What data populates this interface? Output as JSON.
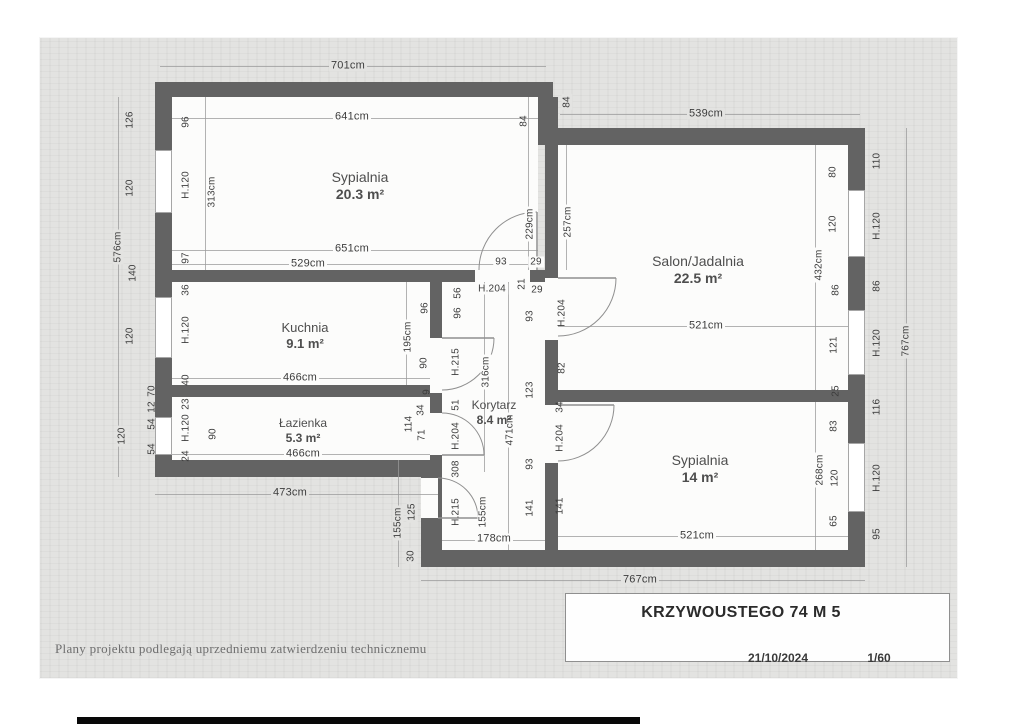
{
  "title_block": {
    "title": "KRZYWOUSTEGO 74 M 5",
    "date": "21/10/2024",
    "scale": "1/60"
  },
  "footer": {
    "note": "Plany projektu podlegają uprzedniemu zatwierdzeniu technicznemu"
  },
  "colors": {
    "paper": "#e3e3e1",
    "wall": "#636363",
    "room_fill": "#fcfcfb",
    "dim_text": "#3c3c3c",
    "dim_line": "#9a9a9a",
    "door_line": "#8f8f8f"
  },
  "plan": {
    "rooms": [
      {
        "name": "Sypialnia",
        "area": "20.3 m²",
        "rect": [
          172,
          97,
          366,
          173
        ],
        "label": [
          360,
          186
        ],
        "size": 14
      },
      {
        "name": "Salon/Jadalnia",
        "area": "22.5 m²",
        "rect": [
          558,
          145,
          290,
          245
        ],
        "label": [
          698,
          270
        ],
        "size": 14
      },
      {
        "name": "Kuchnia",
        "area": "9.1 m²",
        "rect": [
          172,
          282,
          258,
          103
        ],
        "label": [
          305,
          336
        ],
        "size": 13
      },
      {
        "name": "Łazienka",
        "area": "5.3 m²",
        "rect": [
          172,
          397,
          258,
          63
        ],
        "label": [
          303,
          431
        ],
        "size": 12
      },
      {
        "name": "Korytarz",
        "area": "8.4 m²",
        "rect": [
          442,
          282,
          103,
          268
        ],
        "label": [
          494,
          413
        ],
        "size": 12
      },
      {
        "name": "Sypialnia",
        "area": "14 m²",
        "rect": [
          558,
          402,
          290,
          148
        ],
        "label": [
          700,
          469
        ],
        "size": 14
      }
    ],
    "walls": [
      [
        155,
        82,
        398,
        15
      ],
      [
        538,
        97,
        20,
        48
      ],
      [
        545,
        128,
        320,
        17
      ],
      [
        155,
        97,
        17,
        380
      ],
      [
        155,
        460,
        283,
        17
      ],
      [
        421,
        460,
        17,
        107
      ],
      [
        421,
        550,
        444,
        17
      ],
      [
        848,
        128,
        17,
        439
      ],
      [
        155,
        270,
        320,
        12
      ],
      [
        530,
        270,
        28,
        12
      ],
      [
        430,
        282,
        12,
        268
      ],
      [
        155,
        385,
        287,
        12
      ],
      [
        545,
        97,
        13,
        453
      ],
      [
        545,
        390,
        303,
        12
      ]
    ],
    "openings": [
      [
        475,
        270,
        55,
        12
      ],
      [
        545,
        278,
        13,
        62
      ],
      [
        545,
        405,
        13,
        58
      ],
      [
        430,
        338,
        12,
        55
      ],
      [
        430,
        413,
        12,
        42
      ],
      [
        421,
        478,
        17,
        40
      ]
    ],
    "windows": [
      [
        155,
        150,
        17,
        63
      ],
      [
        155,
        297,
        17,
        61
      ],
      [
        155,
        417,
        17,
        38
      ],
      [
        848,
        190,
        17,
        67
      ],
      [
        848,
        310,
        17,
        65
      ],
      [
        848,
        443,
        17,
        69
      ]
    ],
    "dimlines": [
      [
        160,
        66,
        386,
        1
      ],
      [
        172,
        118,
        366,
        1
      ],
      [
        560,
        114,
        300,
        1
      ],
      [
        172,
        250,
        366,
        1
      ],
      [
        172,
        264,
        366,
        1
      ],
      [
        172,
        378,
        258,
        1
      ],
      [
        558,
        326,
        290,
        1
      ],
      [
        172,
        454,
        258,
        1
      ],
      [
        155,
        494,
        283,
        1
      ],
      [
        558,
        536,
        290,
        1
      ],
      [
        442,
        540,
        103,
        1
      ],
      [
        421,
        580,
        444,
        1
      ],
      [
        118,
        97,
        1,
        380
      ],
      [
        906,
        128,
        1,
        439
      ],
      [
        205,
        97,
        1,
        173
      ],
      [
        528,
        97,
        1,
        173
      ],
      [
        566,
        145,
        1,
        125
      ],
      [
        815,
        145,
        1,
        245
      ],
      [
        815,
        402,
        1,
        148
      ],
      [
        484,
        282,
        1,
        190
      ],
      [
        508,
        282,
        1,
        268
      ],
      [
        406,
        282,
        1,
        103
      ],
      [
        398,
        460,
        1,
        107
      ]
    ],
    "labels": [
      {
        "t": "701cm",
        "x": 348,
        "y": 66,
        "s": 11,
        "bg": "p"
      },
      {
        "t": "641cm",
        "x": 352,
        "y": 117,
        "s": 11,
        "bg": "w"
      },
      {
        "t": "84",
        "x": 524,
        "y": 121,
        "v": 1
      },
      {
        "t": "84",
        "x": 567,
        "y": 102,
        "v": 1,
        "bg": "p"
      },
      {
        "t": "539cm",
        "x": 706,
        "y": 114,
        "s": 11,
        "bg": "p"
      },
      {
        "t": "126",
        "x": 130,
        "y": 120,
        "v": 1
      },
      {
        "t": "120",
        "x": 130,
        "y": 188,
        "v": 1
      },
      {
        "t": "576cm",
        "x": 118,
        "y": 247,
        "v": 1,
        "bg": "p"
      },
      {
        "t": "140",
        "x": 133,
        "y": 273,
        "v": 1
      },
      {
        "t": "120",
        "x": 130,
        "y": 336,
        "v": 1
      },
      {
        "t": "70",
        "x": 152,
        "y": 391,
        "v": 1
      },
      {
        "t": "12",
        "x": 152,
        "y": 407,
        "v": 1
      },
      {
        "t": "54",
        "x": 152,
        "y": 424,
        "v": 1
      },
      {
        "t": "54",
        "x": 152,
        "y": 449,
        "v": 1
      },
      {
        "t": "120",
        "x": 122,
        "y": 436,
        "v": 1,
        "bg": "p"
      },
      {
        "t": "96",
        "x": 186,
        "y": 122,
        "v": 1
      },
      {
        "t": "H.120",
        "x": 186,
        "y": 185,
        "v": 1
      },
      {
        "t": "313cm",
        "x": 212,
        "y": 192,
        "v": 1,
        "bg": "w"
      },
      {
        "t": "97",
        "x": 186,
        "y": 258,
        "v": 1
      },
      {
        "t": "651cm",
        "x": 352,
        "y": 249,
        "s": 11,
        "bg": "w"
      },
      {
        "t": "529cm",
        "x": 308,
        "y": 264,
        "s": 11,
        "bg": "w"
      },
      {
        "t": "93",
        "x": 501,
        "y": 262,
        "bg": "w"
      },
      {
        "t": "29",
        "x": 536,
        "y": 262,
        "bg": "w"
      },
      {
        "t": "229cm",
        "x": 530,
        "y": 224,
        "v": 1,
        "bg": "w"
      },
      {
        "t": "257cm",
        "x": 568,
        "y": 222,
        "v": 1,
        "bg": "w"
      },
      {
        "t": "36",
        "x": 186,
        "y": 290,
        "v": 1
      },
      {
        "t": "H.120",
        "x": 186,
        "y": 330,
        "v": 1
      },
      {
        "t": "40",
        "x": 186,
        "y": 380,
        "v": 1
      },
      {
        "t": "466cm",
        "x": 300,
        "y": 378,
        "s": 11,
        "bg": "w"
      },
      {
        "t": "195cm",
        "x": 408,
        "y": 337,
        "v": 1,
        "bg": "w"
      },
      {
        "t": "90",
        "x": 424,
        "y": 363,
        "v": 1
      },
      {
        "t": "96",
        "x": 425,
        "y": 308,
        "v": 1
      },
      {
        "t": "9",
        "x": 427,
        "y": 392,
        "v": 1
      },
      {
        "t": "34",
        "x": 421,
        "y": 410,
        "v": 1
      },
      {
        "t": "23",
        "x": 186,
        "y": 404,
        "v": 1
      },
      {
        "t": "H.120",
        "x": 186,
        "y": 428,
        "v": 1
      },
      {
        "t": "24",
        "x": 186,
        "y": 456,
        "v": 1
      },
      {
        "t": "90",
        "x": 213,
        "y": 434,
        "v": 1
      },
      {
        "t": "466cm",
        "x": 303,
        "y": 454,
        "s": 11,
        "bg": "w"
      },
      {
        "t": "114",
        "x": 409,
        "y": 424,
        "v": 1
      },
      {
        "t": "71",
        "x": 422,
        "y": 435,
        "v": 1
      },
      {
        "t": "473cm",
        "x": 290,
        "y": 493,
        "s": 11,
        "bg": "p"
      },
      {
        "t": "56",
        "x": 458,
        "y": 293,
        "v": 1
      },
      {
        "t": "96",
        "x": 458,
        "y": 313,
        "v": 1
      },
      {
        "t": "H.215",
        "x": 456,
        "y": 362,
        "v": 1
      },
      {
        "t": "51",
        "x": 456,
        "y": 405,
        "v": 1
      },
      {
        "t": "H.204",
        "x": 456,
        "y": 436,
        "v": 1
      },
      {
        "t": "308",
        "x": 456,
        "y": 469,
        "v": 1
      },
      {
        "t": "H.215",
        "x": 456,
        "y": 512,
        "v": 1
      },
      {
        "t": "H.204",
        "x": 492,
        "y": 289,
        "bg": "w"
      },
      {
        "t": "21",
        "x": 522,
        "y": 284,
        "v": 1
      },
      {
        "t": "29",
        "x": 537,
        "y": 290,
        "bg": "w"
      },
      {
        "t": "93",
        "x": 530,
        "y": 316,
        "v": 1
      },
      {
        "t": "123",
        "x": 530,
        "y": 390,
        "v": 1
      },
      {
        "t": "93",
        "x": 530,
        "y": 464,
        "v": 1
      },
      {
        "t": "316cm",
        "x": 486,
        "y": 372,
        "v": 1,
        "bg": "w"
      },
      {
        "t": "471cm",
        "x": 510,
        "y": 430,
        "v": 1,
        "bg": "w"
      },
      {
        "t": "141",
        "x": 530,
        "y": 508,
        "v": 1
      },
      {
        "t": "155cm",
        "x": 483,
        "y": 512,
        "v": 1,
        "bg": "w"
      },
      {
        "t": "178cm",
        "x": 494,
        "y": 539,
        "s": 11,
        "bg": "w"
      },
      {
        "t": "155cm",
        "x": 398,
        "y": 523,
        "v": 1,
        "bg": "p"
      },
      {
        "t": "125",
        "x": 412,
        "y": 512,
        "v": 1,
        "bg": "p"
      },
      {
        "t": "30",
        "x": 411,
        "y": 556,
        "v": 1,
        "bg": "p"
      },
      {
        "t": "521cm",
        "x": 706,
        "y": 326,
        "s": 11,
        "bg": "w"
      },
      {
        "t": "H.204",
        "x": 562,
        "y": 313,
        "v": 1
      },
      {
        "t": "82",
        "x": 562,
        "y": 368,
        "v": 1
      },
      {
        "t": "34",
        "x": 560,
        "y": 407,
        "v": 1
      },
      {
        "t": "H.204",
        "x": 560,
        "y": 438,
        "v": 1
      },
      {
        "t": "141",
        "x": 560,
        "y": 506,
        "v": 1
      },
      {
        "t": "521cm",
        "x": 697,
        "y": 536,
        "s": 11,
        "bg": "w"
      },
      {
        "t": "268cm",
        "x": 820,
        "y": 470,
        "v": 1,
        "bg": "w"
      },
      {
        "t": "80",
        "x": 833,
        "y": 172,
        "v": 1
      },
      {
        "t": "120",
        "x": 833,
        "y": 224,
        "v": 1
      },
      {
        "t": "432cm",
        "x": 819,
        "y": 265,
        "v": 1,
        "bg": "w"
      },
      {
        "t": "86",
        "x": 836,
        "y": 290,
        "v": 1
      },
      {
        "t": "121",
        "x": 834,
        "y": 345,
        "v": 1
      },
      {
        "t": "25",
        "x": 836,
        "y": 391,
        "v": 1
      },
      {
        "t": "83",
        "x": 834,
        "y": 426,
        "v": 1
      },
      {
        "t": "120",
        "x": 835,
        "y": 478,
        "v": 1
      },
      {
        "t": "65",
        "x": 834,
        "y": 521,
        "v": 1
      },
      {
        "t": "110",
        "x": 877,
        "y": 161,
        "v": 1
      },
      {
        "t": "H.120",
        "x": 877,
        "y": 226,
        "v": 1
      },
      {
        "t": "86",
        "x": 877,
        "y": 286,
        "v": 1
      },
      {
        "t": "H.120",
        "x": 877,
        "y": 343,
        "v": 1
      },
      {
        "t": "116",
        "x": 877,
        "y": 407,
        "v": 1
      },
      {
        "t": "H.120",
        "x": 877,
        "y": 478,
        "v": 1
      },
      {
        "t": "95",
        "x": 877,
        "y": 534,
        "v": 1
      },
      {
        "t": "767cm",
        "x": 906,
        "y": 341,
        "v": 1,
        "bg": "p"
      },
      {
        "t": "767cm",
        "x": 640,
        "y": 580,
        "s": 11,
        "bg": "p"
      }
    ],
    "doors": {
      "arcs": [
        "M 479 270 A 58 58 0 0 1 537 212",
        "M 616 278 A 58 58 0 0 1 558 336",
        "M 614 405 A 56 56 0 0 1 558 461",
        "M 494 338 A 52 52 0 0 1 442 390",
        "M 484 455 A 42 42 0 0 0 442 413",
        "M 478 518 A 40 40 0 0 0 438 478"
      ],
      "leaves": [
        [
          537,
          212,
          537,
          270
        ],
        [
          558,
          278,
          616,
          278
        ],
        [
          558,
          405,
          614,
          405
        ],
        [
          442,
          338,
          494,
          338
        ],
        [
          442,
          455,
          484,
          455
        ],
        [
          438,
          518,
          478,
          518
        ]
      ]
    }
  }
}
